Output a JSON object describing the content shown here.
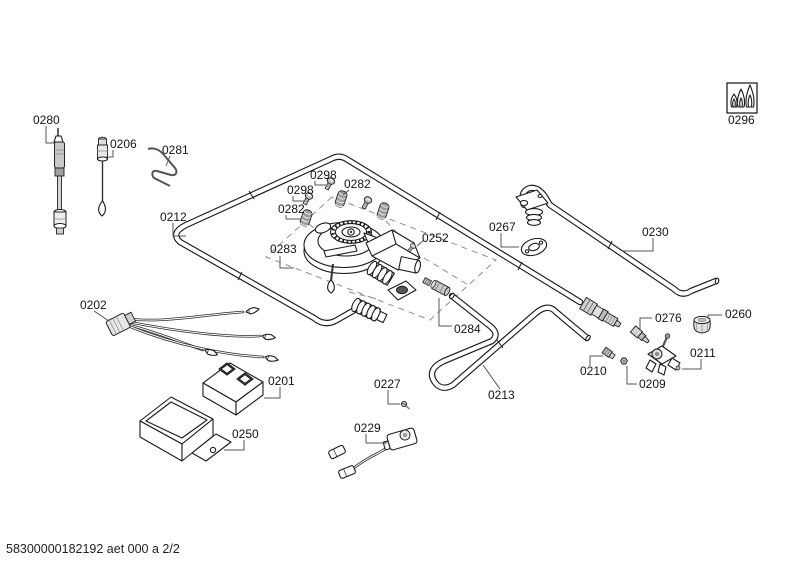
{
  "footer": {
    "code": "58300000182192 aet 000 a 2/2"
  },
  "icons": {
    "flame_symbol": "triple-flame-icon"
  },
  "parts": [
    {
      "label": "0280"
    },
    {
      "label": "0206"
    },
    {
      "label": "0281"
    },
    {
      "label": "0212"
    },
    {
      "label": "0298"
    },
    {
      "label": "0282"
    },
    {
      "label": "0298"
    },
    {
      "label": "0282"
    },
    {
      "label": "0283"
    },
    {
      "label": "0252"
    },
    {
      "label": "0267"
    },
    {
      "label": "0230"
    },
    {
      "label": "0296"
    },
    {
      "label": "0202"
    },
    {
      "label": "0201"
    },
    {
      "label": "0250"
    },
    {
      "label": "0227"
    },
    {
      "label": "0229"
    },
    {
      "label": "0284"
    },
    {
      "label": "0213"
    },
    {
      "label": "0210"
    },
    {
      "label": "0209"
    },
    {
      "label": "0276"
    },
    {
      "label": "0260"
    },
    {
      "label": "0211"
    }
  ]
}
